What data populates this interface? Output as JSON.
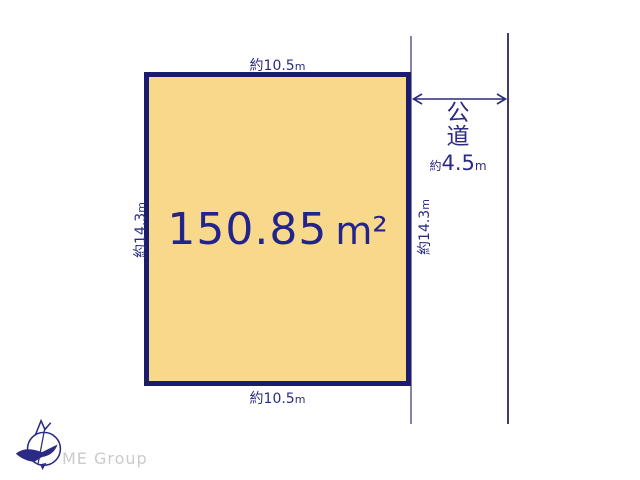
{
  "plot": {
    "area": {
      "value": "150.85",
      "unit": "m²"
    }
  },
  "dimensions": {
    "top": {
      "prefix": "約",
      "value": "10.5",
      "unit": "m"
    },
    "bottom": {
      "prefix": "約",
      "value": "10.5",
      "unit": "m"
    },
    "left": {
      "prefix": "約",
      "value": "14.3",
      "unit": "m"
    },
    "right": {
      "prefix": "約",
      "value": "14.3",
      "unit": "m"
    }
  },
  "road": {
    "name_top": "公",
    "name_bottom": "道",
    "width": {
      "prefix": "約",
      "value": "4.5",
      "unit": "m"
    }
  },
  "logo": {
    "text": "ME Group",
    "icon": "compass-north-bird-icon"
  },
  "colors": {
    "plot_fill": "#F8D98C",
    "plot_border": "#1C1C6F",
    "text_navy": "#2B2B85",
    "area_text": "#23238C",
    "road_line_left": "#8585A2",
    "road_line_right": "#3D3D6E",
    "arrow": "#2A2A80",
    "logo_gray": "#CBCBCB",
    "logo_navy": "#2B2B85"
  }
}
